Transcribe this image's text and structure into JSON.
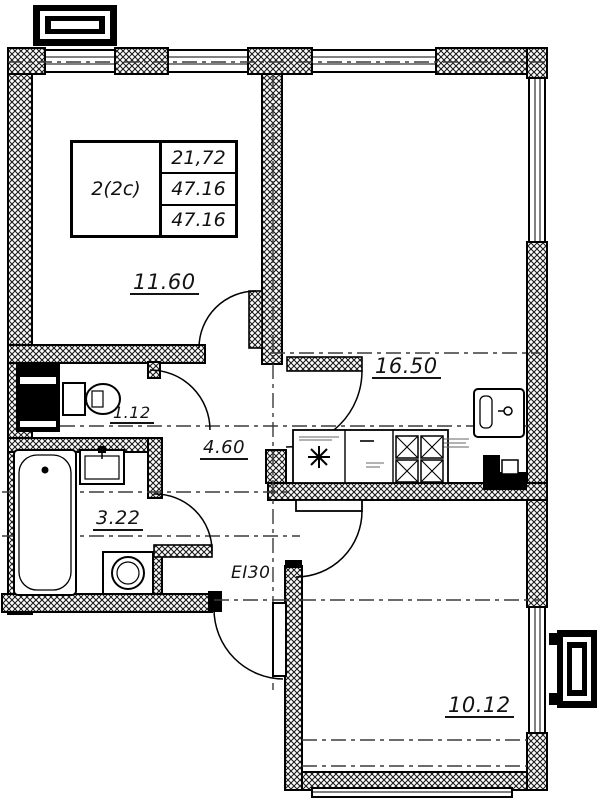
{
  "title": "Apartment floor plan",
  "stamp": {
    "apartment_type": "2(2c)",
    "values": [
      "21,72",
      "47.16",
      "47.16"
    ]
  },
  "labels": {
    "room1_area": "11.60",
    "kitchen_living_area": "16.50",
    "wc_area": "1.12",
    "hallway_area": "4.60",
    "bathroom_area": "3.22",
    "entrance_door_fire_rating": "EI30",
    "room2_area": "10.12"
  },
  "colors": {
    "line": "#000000",
    "background": "#ffffff",
    "axis_line": "#3a3a3a"
  }
}
